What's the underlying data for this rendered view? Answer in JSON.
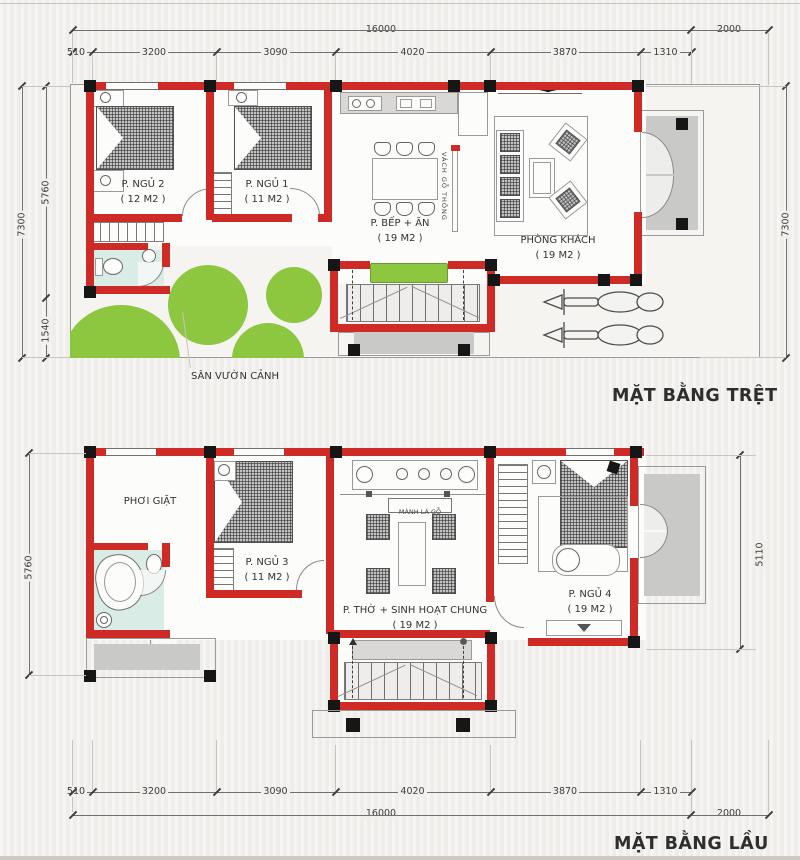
{
  "titles": {
    "ground": "MẶT BẰNG TRỆT",
    "upper": "MẶT BẰNG LẦU"
  },
  "ground_floor": {
    "rooms": [
      {
        "name": "P. NGỦ 2",
        "area": "( 12 M2 )"
      },
      {
        "name": "P. NGỦ 1",
        "area": "( 11 M2 )"
      },
      {
        "name": "P. BẾP + ĂN",
        "area": "( 19 M2 )"
      },
      {
        "name": "PHÒNG KHÁCH",
        "area": "( 19 M2 )"
      }
    ],
    "garden_label": "SÂN VƯỜN CẢNH",
    "partition_label": "VÁCH GỖ THÔNG"
  },
  "upper_floor": {
    "rooms": [
      {
        "name": "PHƠI GIẶT",
        "area": ""
      },
      {
        "name": "P. NGỦ 3",
        "area": "( 11 M2 )"
      },
      {
        "name": "P. THỜ + SINH HOẠT CHUNG",
        "area": "( 19 M2 )"
      },
      {
        "name": "P. NGỦ 4",
        "area": "( 19 M2 )"
      }
    ],
    "blind_label": "MÀNH LÁ GỖ"
  },
  "dimensions": {
    "top": {
      "total": "16000",
      "side": "2000",
      "segments": [
        "510",
        "3200",
        "3090",
        "4020",
        "3870",
        "1310"
      ]
    },
    "bottom": {
      "total": "16000",
      "side": "2000",
      "segments": [
        "510",
        "3200",
        "3090",
        "4020",
        "3870",
        "1310"
      ]
    },
    "ground_left": {
      "overall": "7300",
      "upper": "5760",
      "lower": "1540"
    },
    "ground_right": {
      "overall": "7300"
    },
    "upper_left": {
      "overall": "5760"
    },
    "upper_right": {
      "overall": "5110"
    }
  },
  "colors": {
    "wall": "#ce2b26",
    "garden": "#8dc63f",
    "bath": "#d9ece6",
    "porch": "#c9c9c8"
  }
}
